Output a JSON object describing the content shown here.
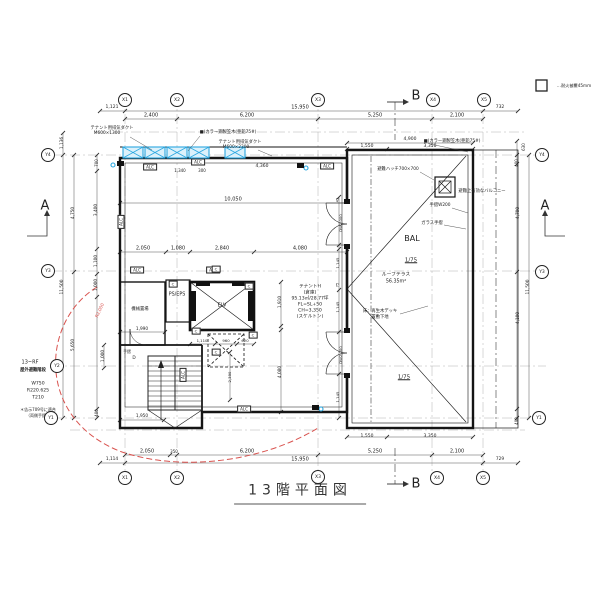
{
  "title": "13階平面図",
  "legend": {
    "fire_cover": "…耐火被覆45mm"
  },
  "labels": [
    {
      "t": "1,121",
      "x": 112,
      "y": 108,
      "s": 4.5
    },
    {
      "t": "15,950",
      "x": 300,
      "y": 108
    },
    {
      "t": "732",
      "x": 500,
      "y": 108,
      "s": 4.5
    },
    {
      "t": "2,400",
      "x": 151,
      "y": 116
    },
    {
      "t": "6,200",
      "x": 247,
      "y": 116
    },
    {
      "t": "5,250",
      "x": 375,
      "y": 116
    },
    {
      "t": "2,100",
      "x": 457,
      "y": 116
    },
    {
      "t": "4,900",
      "x": 410,
      "y": 140,
      "s": 4.5
    },
    {
      "t": "1,550",
      "x": 367,
      "y": 147,
      "s": 4.5
    },
    {
      "t": "3,350",
      "x": 430,
      "y": 147,
      "s": 4.5
    },
    {
      "t": "テナント用排気ダクト",
      "x": 112,
      "y": 129,
      "s": 4.3,
      "n": "annotation-duct-1"
    },
    {
      "t": "M600×1300",
      "x": 107,
      "y": 134,
      "s": 4.3
    },
    {
      "t": "■(カラー鋼製笠木(亜鉛75#)",
      "x": 228,
      "y": 133,
      "s": 4.3,
      "n": "annotation-coping-1"
    },
    {
      "t": "テナント用排気ダクト",
      "x": 240,
      "y": 143,
      "s": 4.3,
      "n": "annotation-duct-2"
    },
    {
      "t": "M600×2300",
      "x": 236,
      "y": 148,
      "s": 4.3
    },
    {
      "t": "■(カラー鋼製笠木(亜鉛75#)",
      "x": 452,
      "y": 142,
      "s": 4.3,
      "n": "annotation-coping-2"
    },
    {
      "t": "ALC",
      "x": 150,
      "y": 167,
      "s": 4,
      "box": true
    },
    {
      "t": "1,340",
      "x": 180,
      "y": 171,
      "s": 4
    },
    {
      "t": "ALC",
      "x": 198,
      "y": 162,
      "s": 4,
      "box": true
    },
    {
      "t": "300",
      "x": 202,
      "y": 171,
      "s": 4
    },
    {
      "t": "4,360",
      "x": 262,
      "y": 167,
      "s": 4.5
    },
    {
      "t": "ALC",
      "x": 327,
      "y": 166,
      "s": 4,
      "box": true
    },
    {
      "t": "10,050",
      "x": 233,
      "y": 200
    },
    {
      "t": "避難ハッチ700×700",
      "x": 398,
      "y": 170,
      "s": 4.3,
      "n": "annotation-escape-hatch"
    },
    {
      "t": "避難上有効なバルコニー",
      "x": 482,
      "y": 192,
      "s": 4.3,
      "n": "annotation-balcony-note"
    },
    {
      "t": "手摺W200",
      "x": 440,
      "y": 206,
      "s": 4.3,
      "n": "annotation-handrail"
    },
    {
      "t": "ガラス手摺",
      "x": 432,
      "y": 224,
      "s": 4.3,
      "n": "annotation-glass-rail"
    },
    {
      "t": "BAL",
      "x": 412,
      "y": 239,
      "s": 8,
      "n": "room-label-balcony"
    },
    {
      "t": "1/75",
      "x": 411,
      "y": 261,
      "s": 5.5,
      "u": true,
      "n": "slope-label"
    },
    {
      "t": "ルーフテラス",
      "x": 396,
      "y": 276,
      "s": 4.8,
      "n": "annotation-roof-terrace"
    },
    {
      "t": "56.35m²",
      "x": 396,
      "y": 283,
      "s": 4.8
    },
    {
      "t": "床：再生木デッキ",
      "x": 380,
      "y": 312,
      "s": 4.3,
      "n": "annotation-deck"
    },
    {
      "t": "置敷下地",
      "x": 380,
      "y": 318,
      "s": 4.3
    },
    {
      "t": "1/75",
      "x": 404,
      "y": 378,
      "s": 5.5,
      "u": true,
      "n": "slope-label"
    },
    {
      "t": "DW2,000",
      "x": 341,
      "y": 223,
      "r": -90,
      "s": 3.8
    },
    {
      "t": "45",
      "x": 338,
      "y": 200,
      "r": -90,
      "s": 3.5
    },
    {
      "t": "1,145",
      "x": 338,
      "y": 263,
      "r": -90,
      "s": 3.8
    },
    {
      "t": "75",
      "x": 338,
      "y": 285,
      "r": -90,
      "s": 3.5
    },
    {
      "t": "1,145",
      "x": 338,
      "y": 307,
      "r": -90,
      "s": 3.8
    },
    {
      "t": "DW2,000",
      "x": 341,
      "y": 355,
      "r": -90,
      "s": 3.8
    },
    {
      "t": "1,145",
      "x": 338,
      "y": 397,
      "r": -90,
      "s": 3.8
    },
    {
      "t": "PS/EPS",
      "x": 177,
      "y": 296,
      "s": 4.8,
      "n": "room-label-ps-eps"
    },
    {
      "t": "ELV",
      "x": 222,
      "y": 306,
      "s": 5,
      "n": "room-label-elevator"
    },
    {
      "t": "機械置場",
      "x": 140,
      "y": 310,
      "s": 4.3,
      "n": "room-label-storage"
    },
    {
      "t": "手摺",
      "x": 127,
      "y": 352,
      "s": 3.8
    },
    {
      "t": "D",
      "x": 134,
      "y": 359,
      "s": 4.3
    },
    {
      "t": "テナントH",
      "x": 310,
      "y": 288,
      "s": 4.6,
      "n": "room-label-tenant"
    },
    {
      "t": "(倉庫)",
      "x": 310,
      "y": 294,
      "s": 4.6
    },
    {
      "t": "95.13㎡/28.77坪",
      "x": 310,
      "y": 300,
      "s": 4.6
    },
    {
      "t": "FL=SL+50",
      "x": 310,
      "y": 306,
      "s": 4.6
    },
    {
      "t": "CH=3,350",
      "x": 310,
      "y": 312,
      "s": 4.6
    },
    {
      "t": "(スケルトン)",
      "x": 310,
      "y": 318,
      "s": 4.6
    },
    {
      "t": "2,050",
      "x": 143,
      "y": 249
    },
    {
      "t": "1,080",
      "x": 178,
      "y": 249
    },
    {
      "t": "2,840",
      "x": 222,
      "y": 249
    },
    {
      "t": "4,080",
      "x": 300,
      "y": 249
    },
    {
      "t": "1,990",
      "x": 142,
      "y": 330,
      "s": 4.3
    },
    {
      "t": "1,110",
      "x": 202,
      "y": 341,
      "s": 3.8
    },
    {
      "t": "960",
      "x": 226,
      "y": 341,
      "s": 3.8
    },
    {
      "t": "620",
      "x": 245,
      "y": 341,
      "s": 3.8
    },
    {
      "t": "1,910",
      "x": 281,
      "y": 302,
      "r": -90,
      "s": 4.3
    },
    {
      "t": "4,080",
      "x": 281,
      "y": 372,
      "r": -90,
      "s": 4.3
    },
    {
      "t": "1,950",
      "x": 142,
      "y": 417,
      "s": 4.3
    },
    {
      "t": "1,000",
      "x": 104,
      "y": 356,
      "r": -90,
      "s": 4.3
    },
    {
      "t": "2,390",
      "x": 230,
      "y": 377,
      "r": -90,
      "s": 3.8
    },
    {
      "t": "ALC",
      "x": 137,
      "y": 270,
      "s": 4,
      "box": true
    },
    {
      "t": "ALC",
      "x": 213,
      "y": 270,
      "s": 4,
      "box": true
    },
    {
      "t": "ALC",
      "x": 121,
      "y": 222,
      "r": -90,
      "s": 4,
      "box": true
    },
    {
      "t": "ALC",
      "x": 183,
      "y": 375,
      "r": -90,
      "s": 4,
      "box": true
    },
    {
      "t": "ALC",
      "x": 244,
      "y": 409,
      "s": 4,
      "box": true
    },
    {
      "t": "C",
      "x": 173,
      "y": 284,
      "s": 3.8,
      "box": true
    },
    {
      "t": "C",
      "x": 216,
      "y": 269,
      "s": 3.8,
      "box": true
    },
    {
      "t": "C",
      "x": 249,
      "y": 286,
      "s": 3.8,
      "box": true
    },
    {
      "t": "C",
      "x": 196,
      "y": 331,
      "s": 3.8,
      "box": true
    },
    {
      "t": "C",
      "x": 253,
      "y": 335,
      "s": 3.8,
      "box": true
    },
    {
      "t": "C",
      "x": 216,
      "y": 352,
      "s": 3.8,
      "box": true
    },
    {
      "t": "13~RF",
      "x": 30,
      "y": 363,
      "s": 5,
      "n": "stair-note-floors"
    },
    {
      "t": "屋外避難階段",
      "x": 33,
      "y": 371,
      "s": 4.3,
      "b": true,
      "n": "stair-note-name"
    },
    {
      "t": "W750",
      "x": 38,
      "y": 385,
      "s": 4.6
    },
    {
      "t": "R220.625",
      "x": 38,
      "y": 392,
      "s": 4.6
    },
    {
      "t": "T210",
      "x": 38,
      "y": 399,
      "s": 4.6
    },
    {
      "t": "＊告示709号に適合",
      "x": 38,
      "y": 410,
      "s": 4
    },
    {
      "t": "（両側手摺）",
      "x": 38,
      "y": 416,
      "s": 4
    },
    {
      "t": "1,136",
      "x": 63,
      "y": 143,
      "r": -90,
      "s": 4.3
    },
    {
      "t": "700",
      "x": 97,
      "y": 163,
      "r": -90,
      "s": 4
    },
    {
      "t": "3,400",
      "x": 97,
      "y": 210,
      "r": -90,
      "s": 4.3
    },
    {
      "t": "4,750",
      "x": 74,
      "y": 213,
      "r": -90,
      "s": 4.3
    },
    {
      "t": "1,100",
      "x": 97,
      "y": 261,
      "r": -90,
      "s": 4.3
    },
    {
      "t": "1,000",
      "x": 97,
      "y": 285,
      "r": -90,
      "s": 4.3
    },
    {
      "t": "11,500",
      "x": 63,
      "y": 287,
      "r": -90,
      "s": 4.3
    },
    {
      "t": "5,650",
      "x": 74,
      "y": 345,
      "r": -90,
      "s": 4.3
    },
    {
      "t": "400",
      "x": 97,
      "y": 413,
      "r": -90,
      "s": 4
    },
    {
      "t": "630",
      "x": 524,
      "y": 147,
      "r": -90,
      "s": 4
    },
    {
      "t": "400",
      "x": 517,
      "y": 163,
      "r": -90,
      "s": 4
    },
    {
      "t": "4,700",
      "x": 519,
      "y": 213,
      "r": -90,
      "s": 4.3
    },
    {
      "t": "11,500",
      "x": 529,
      "y": 287,
      "r": -90,
      "s": 4.3
    },
    {
      "t": "4,100",
      "x": 519,
      "y": 318,
      "r": -90,
      "s": 4.3
    },
    {
      "t": "400",
      "x": 517,
      "y": 421,
      "r": -90,
      "s": 4
    },
    {
      "t": "1,550",
      "x": 367,
      "y": 437,
      "s": 4.5
    },
    {
      "t": "3,350",
      "x": 430,
      "y": 437,
      "s": 4.5
    },
    {
      "t": "2,050",
      "x": 147,
      "y": 452
    },
    {
      "t": "350",
      "x": 174,
      "y": 452,
      "s": 4
    },
    {
      "t": "6,200",
      "x": 247,
      "y": 452
    },
    {
      "t": "5,250",
      "x": 375,
      "y": 452
    },
    {
      "t": "2,100",
      "x": 457,
      "y": 452
    },
    {
      "t": "1,114",
      "x": 112,
      "y": 460,
      "s": 4.3
    },
    {
      "t": "15,950",
      "x": 300,
      "y": 460
    },
    {
      "t": "729",
      "x": 500,
      "y": 460,
      "s": 4.3
    },
    {
      "t": "A",
      "x": 45,
      "y": 206,
      "s": 13,
      "n": "section-marker-a-left"
    },
    {
      "t": "A",
      "x": 545,
      "y": 206,
      "s": 13,
      "n": "section-marker-a-right"
    },
    {
      "t": "B",
      "x": 416,
      "y": 96,
      "s": 13,
      "n": "section-marker-b-top"
    },
    {
      "t": "B",
      "x": 416,
      "y": 484,
      "s": 13,
      "n": "section-marker-b-bottom"
    },
    {
      "t": "R2,000",
      "x": 101,
      "y": 311,
      "r": -65,
      "s": 4.3,
      "c": "#d9534f",
      "n": "annotation-radius"
    },
    {
      "t": "…耐火被覆45mm",
      "x": 574,
      "y": 86,
      "s": 4.2,
      "n": "legend-fireproofing-label"
    }
  ],
  "bubbles": [
    {
      "t": "X1",
      "x": 125,
      "y": 100
    },
    {
      "t": "X2",
      "x": 177,
      "y": 100
    },
    {
      "t": "X3",
      "x": 318,
      "y": 100
    },
    {
      "t": "X4",
      "x": 433,
      "y": 100
    },
    {
      "t": "X5",
      "x": 484,
      "y": 100
    },
    {
      "t": "X1",
      "x": 125,
      "y": 478
    },
    {
      "t": "X2",
      "x": 177,
      "y": 478
    },
    {
      "t": "X3",
      "x": 318,
      "y": 477
    },
    {
      "t": "X4",
      "x": 437,
      "y": 478
    },
    {
      "t": "X5",
      "x": 483,
      "y": 478
    },
    {
      "t": "Y4",
      "x": 48,
      "y": 155
    },
    {
      "t": "Y3",
      "x": 48,
      "y": 271
    },
    {
      "t": "Y2",
      "x": 57,
      "y": 366
    },
    {
      "t": "Y1",
      "x": 51,
      "y": 418
    },
    {
      "t": "Y4",
      "x": 542,
      "y": 155
    },
    {
      "t": "Y3",
      "x": 542,
      "y": 272
    },
    {
      "t": "Y1",
      "x": 539,
      "y": 418
    }
  ]
}
